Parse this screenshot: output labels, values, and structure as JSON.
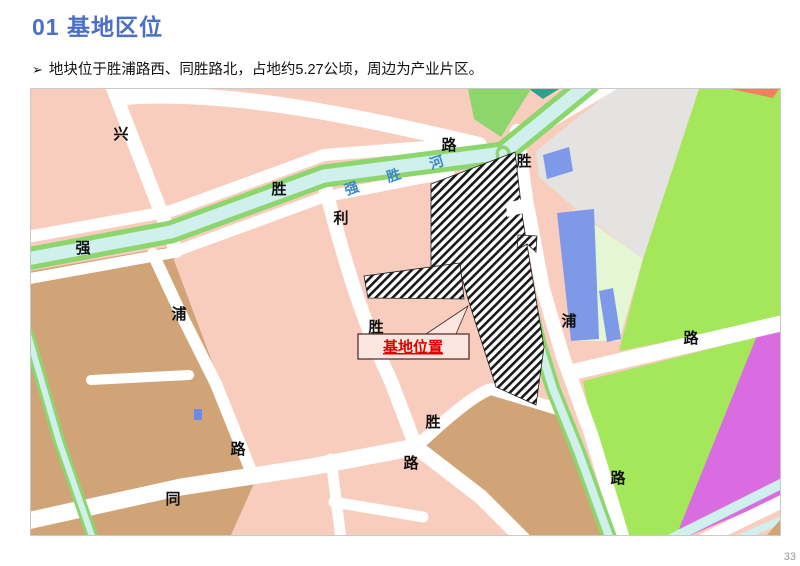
{
  "page": {
    "title": "01 基地区位",
    "bullet_marker": "➢",
    "bullet": "地块位于胜浦路西、同胜路北，占地约5.27公顷，周边为产业片区。",
    "page_number": "33"
  },
  "map": {
    "callout": {
      "label": "基地位置"
    },
    "river_label": {
      "text": "强胜河",
      "chars": [
        {
          "text": "强"
        },
        {
          "text": "胜"
        },
        {
          "text": "河"
        }
      ],
      "color": "#3d87c9"
    },
    "road_labels": [
      {
        "text": "兴"
      },
      {
        "text": "路"
      },
      {
        "text": "胜"
      },
      {
        "text": "胜"
      },
      {
        "text": "利"
      },
      {
        "text": "强"
      },
      {
        "text": "浦"
      },
      {
        "text": "胜"
      },
      {
        "text": "浦"
      },
      {
        "text": "路"
      },
      {
        "text": "胜"
      },
      {
        "text": "路"
      },
      {
        "text": "路"
      },
      {
        "text": "同"
      },
      {
        "text": "路"
      }
    ],
    "named_roads": [
      "兴路",
      "胜利路",
      "强浦路",
      "胜浦路",
      "同胜路"
    ],
    "river_name": "强胜河",
    "colors": {
      "title_blue": "#4a6fc4",
      "parcel_pink": "#f9cdbe",
      "parcel_tan": "#d0a476",
      "parcel_gray": "#e4e3e1",
      "green_bright": "#a4e75a",
      "green_pale": "#e5f6d5",
      "water_cyan": "#cff0ed",
      "bank_green": "#8cd66d",
      "parcel_blue": "#7d99e8",
      "parcel_magenta": "#d96ce0",
      "road_white": "#ffffff",
      "callout_red": "#e00000",
      "hatch_black": "#1a1a1a"
    }
  }
}
